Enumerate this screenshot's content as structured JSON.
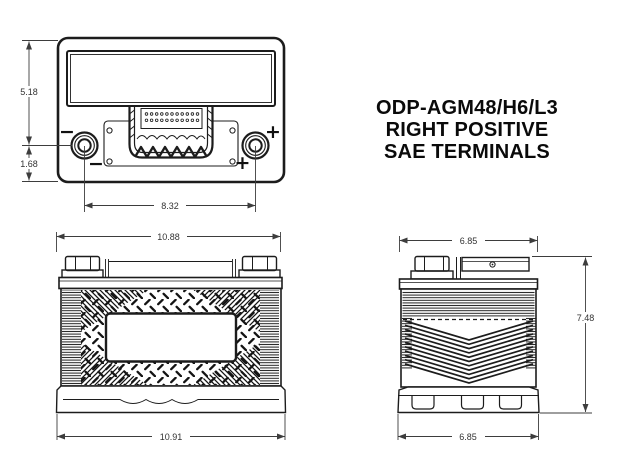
{
  "title": {
    "line1": "ODP-AGM48/H6/L3",
    "line2": "RIGHT POSITIVE",
    "line3": "SAE TERMINALS"
  },
  "symbols": {
    "negative": "−",
    "positive": "+"
  },
  "dimensions": {
    "top_view": {
      "overall_height": "5.18",
      "terminal_to_edge": "1.68",
      "terminal_spacing": "8.32"
    },
    "front_view": {
      "top_width": "10.88",
      "base_width": "10.91"
    },
    "side_view": {
      "top_depth": "6.85",
      "height": "7.48",
      "base_depth": "6.85"
    }
  },
  "colors": {
    "line": "#1c1c1c",
    "dimension": "#3d3d3d",
    "background": "#ffffff"
  }
}
